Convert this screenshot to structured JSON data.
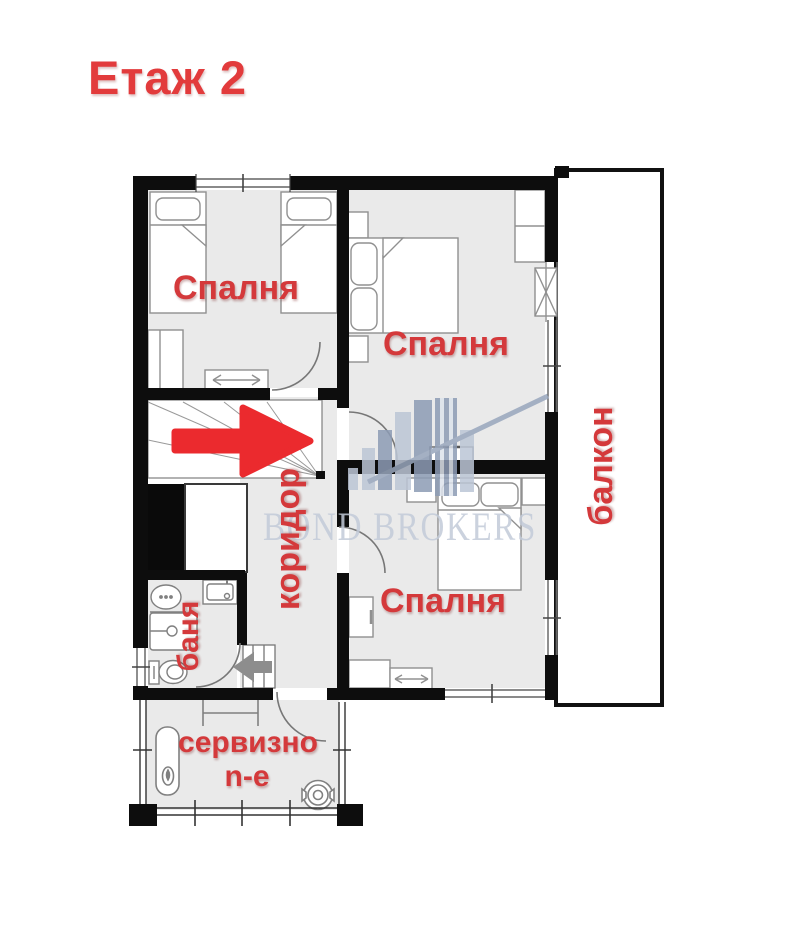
{
  "title": "Етаж 2",
  "watermark": {
    "text": "BOND BROKERS"
  },
  "rooms": {
    "bedroom_top_left": "Спалня",
    "bedroom_top_right": "Спалня",
    "bedroom_bottom": "Спалня",
    "corridor": "коридор",
    "bathroom": "баня",
    "balcony": "балкон",
    "service_line1": "сервизно",
    "service_line2": "n-e"
  },
  "colors": {
    "label_red": "#d4393b",
    "title_red": "#e23b3c",
    "wall_black": "#0d0d0d",
    "floor_gray": "#eaeaea",
    "watermark_blue": "#c3cbd9",
    "logo_blue_dark": "#8d9cb5",
    "logo_blue_light": "#bcc6d6",
    "arrow_red": "#eb2a2e",
    "arrow_gray": "#8d8d8d"
  }
}
